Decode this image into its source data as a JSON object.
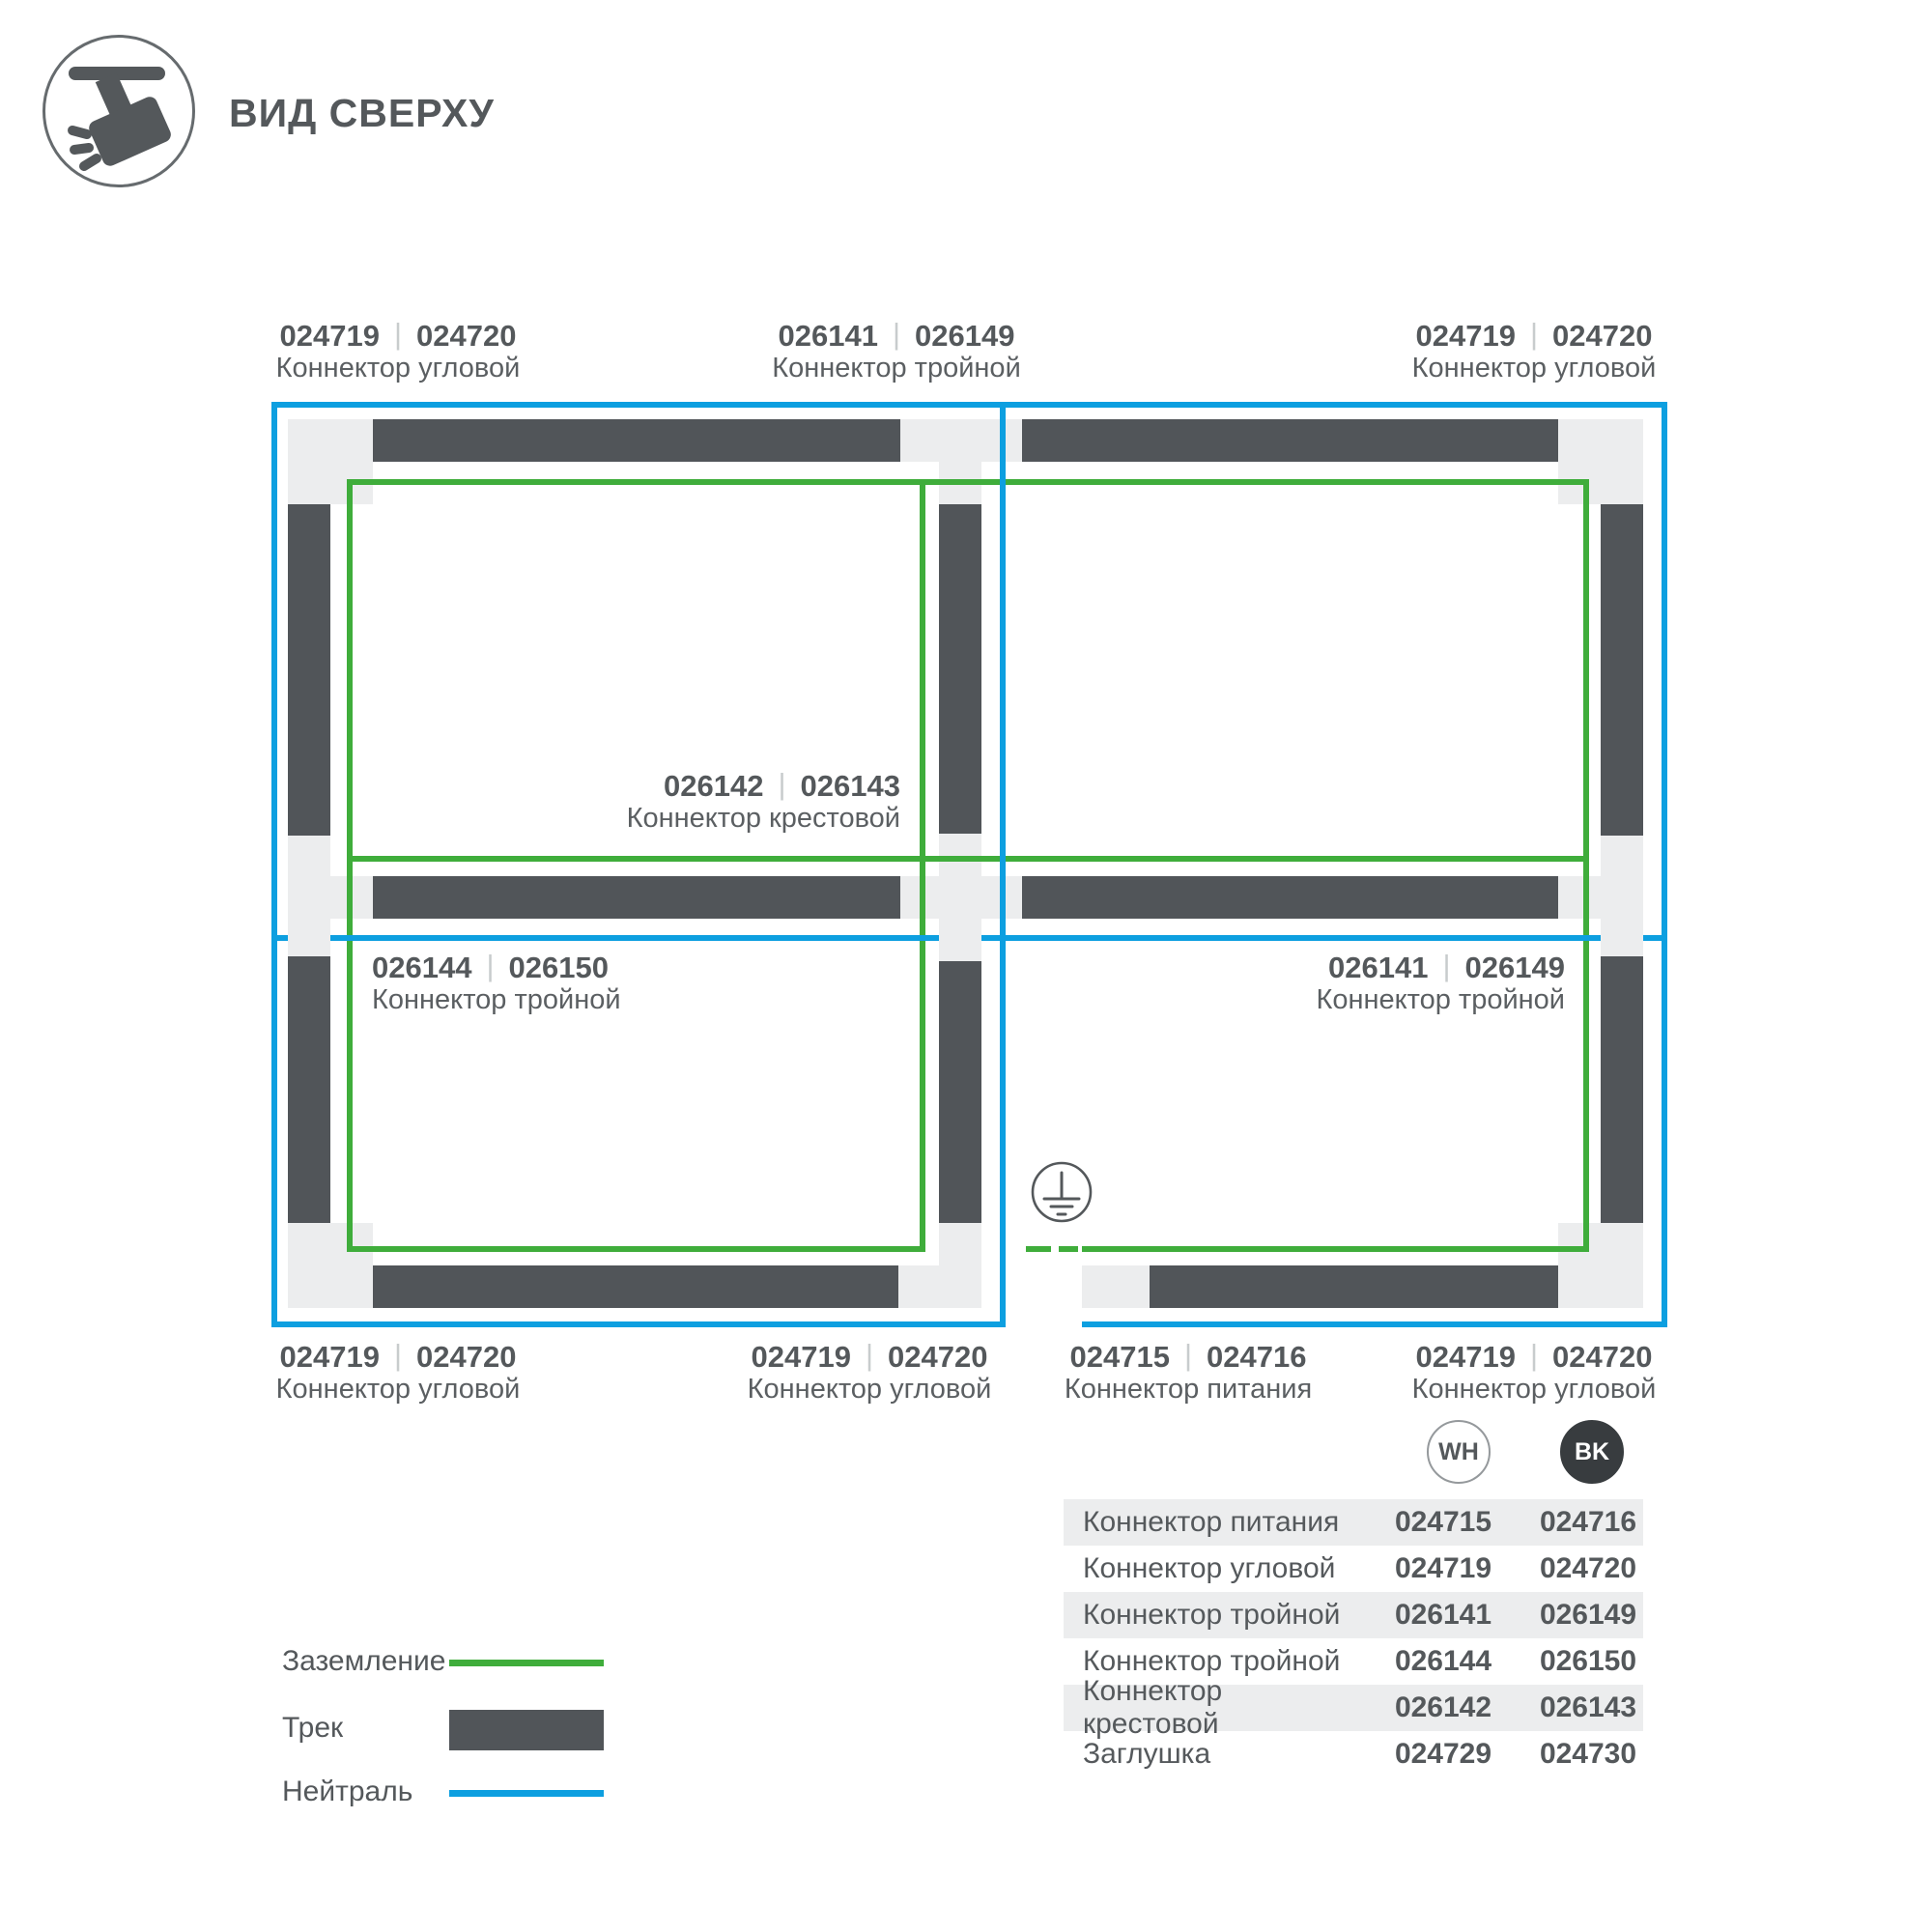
{
  "header": {
    "title": "ВИД СВЕРХУ"
  },
  "diagram": {
    "separator": "|",
    "labels": [
      {
        "id": "top-left",
        "code_wh": "024719",
        "code_bk": "024720",
        "name": "Коннектор угловой"
      },
      {
        "id": "top-middle",
        "code_wh": "026141",
        "code_bk": "026149",
        "name": "Коннектор тройной"
      },
      {
        "id": "top-right",
        "code_wh": "024719",
        "code_bk": "024720",
        "name": "Коннектор угловой"
      },
      {
        "id": "center-cross",
        "code_wh": "026142",
        "code_bk": "026143",
        "name": "Коннектор крестовой"
      },
      {
        "id": "middle-left",
        "code_wh": "026144",
        "code_bk": "026150",
        "name": "Коннектор тройной"
      },
      {
        "id": "middle-right",
        "code_wh": "026141",
        "code_bk": "026149",
        "name": "Коннектор тройной"
      },
      {
        "id": "bottom-left",
        "code_wh": "024719",
        "code_bk": "024720",
        "name": "Коннектор угловой"
      },
      {
        "id": "bottom-center",
        "code_wh": "024719",
        "code_bk": "024720",
        "name": "Коннектор угловой"
      },
      {
        "id": "bottom-feed",
        "code_wh": "024715",
        "code_bk": "024716",
        "name": "Коннектор питания"
      },
      {
        "id": "bottom-right",
        "code_wh": "024719",
        "code_bk": "024720",
        "name": "Коннектор угловой"
      }
    ]
  },
  "legend": {
    "items": [
      {
        "label": "Заземление",
        "type": "ground-line"
      },
      {
        "label": "Трек",
        "type": "track-bar"
      },
      {
        "label": "Нейтраль",
        "type": "neutral-line"
      }
    ]
  },
  "table": {
    "columns": [
      {
        "code": "WH"
      },
      {
        "code": "BK"
      }
    ],
    "rows": [
      {
        "name": "Коннектор питания",
        "wh": "024715",
        "bk": "024716"
      },
      {
        "name": "Коннектор угловой",
        "wh": "024719",
        "bk": "024720"
      },
      {
        "name": "Коннектор тройной",
        "wh": "026141",
        "bk": "026149"
      },
      {
        "name": "Коннектор тройной",
        "wh": "026144",
        "bk": "026150"
      },
      {
        "name": "Коннектор крестовой",
        "wh": "026142",
        "bk": "026143"
      },
      {
        "name": "Заглушка",
        "wh": "024729",
        "bk": "024730"
      }
    ]
  },
  "colors": {
    "accent_green": "#3FAD3B",
    "accent_blue": "#0D9FE0",
    "track": "#515559",
    "connector": "#ECEDEE",
    "text": "#54585B",
    "stripe": "#ECEDEE",
    "badge_bk": "#383C3F",
    "separator": "#C8CCCD"
  }
}
